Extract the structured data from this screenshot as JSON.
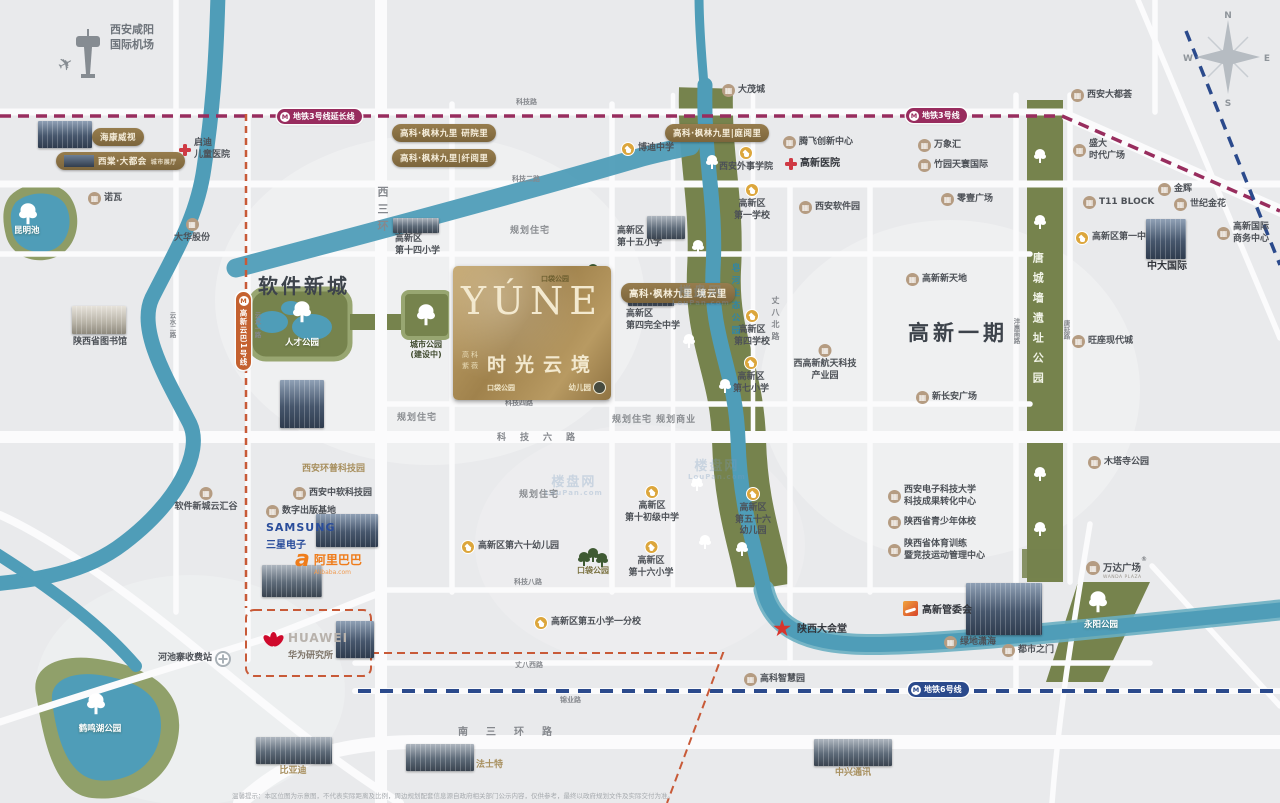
{
  "project": {
    "name_en": "YÚNE",
    "name_cn": "时光云境",
    "dev1": "高科",
    "dev2": "紫薇",
    "pocket_park": "口袋公园",
    "kindergarten": "幼儿园"
  },
  "airport": {
    "line1": "西安咸阳",
    "line2": "国际机场"
  },
  "compass": {
    "n": "N",
    "w": "W",
    "s": "S",
    "e": "E"
  },
  "metro": {
    "mark": "M",
    "line3_ext": "地铁3号线延长线",
    "line3": "地铁3号线",
    "line6": "地铁6号线",
    "cloud_rail": "高新云巴1号线"
  },
  "districts": [
    {
      "id": "software-new-town",
      "label": "软件新城"
    },
    {
      "id": "gaoxin-phase1",
      "label": "高新一期"
    }
  ],
  "badges": [
    {
      "id": "hikvision",
      "t": "海康威视",
      "x": 92,
      "y": 128
    },
    {
      "id": "xitang",
      "t": "西棠·大都会",
      "sub": "城市展厅",
      "x": 56,
      "y": 152,
      "pic": true
    },
    {
      "id": "fenglin-1",
      "t": "高科·枫林九里 研院里",
      "x": 392,
      "y": 124
    },
    {
      "id": "fenglin-2",
      "t": "高科·枫林九里|纤阅里",
      "x": 392,
      "y": 149
    },
    {
      "id": "fenglin-3",
      "t": "高科·枫林九里|庭阅里",
      "x": 665,
      "y": 124
    },
    {
      "id": "fenglin-4",
      "t": "高科·枫林九里 境云里",
      "x": 621,
      "y": 283,
      "fs": 9.5
    }
  ],
  "pois": [
    {
      "id": "damaocheng",
      "icon": "bldg",
      "label": "大茂城",
      "x": 722,
      "y": 84
    },
    {
      "id": "nuowa",
      "icon": "bldg",
      "label": "诺瓦",
      "x": 88,
      "y": 192
    },
    {
      "id": "dahua",
      "icon": "bldg",
      "label": "大华股份",
      "x": 192,
      "y": 218,
      "cls": "col"
    },
    {
      "id": "qidi-hospital",
      "icon": "cross",
      "label": "启迪\n儿童医院",
      "x": 178,
      "y": 138
    },
    {
      "id": "bodi-school",
      "icon": "school",
      "label": "博迪中学",
      "x": 621,
      "y": 142
    },
    {
      "id": "waishi-college",
      "icon": "school",
      "label": "西安外事学院",
      "x": 746,
      "y": 146,
      "cls": "col"
    },
    {
      "id": "tengfei",
      "icon": "bldg",
      "label": "腾飞创新中心",
      "x": 783,
      "y": 136
    },
    {
      "id": "gaoxin-hospital",
      "icon": "cross",
      "label": "高新医院",
      "x": 784,
      "y": 157,
      "cls": "dark"
    },
    {
      "id": "wanxianghui",
      "icon": "bldg",
      "label": "万象汇",
      "x": 918,
      "y": 139
    },
    {
      "id": "zhuyuan",
      "icon": "bldg",
      "label": "竹园天寰国际",
      "x": 918,
      "y": 159
    },
    {
      "id": "daduhui",
      "icon": "bldg",
      "label": "西安大都荟",
      "x": 1071,
      "y": 89
    },
    {
      "id": "shengda",
      "icon": "bldg",
      "label": "盛大\n时代广场",
      "x": 1073,
      "y": 139
    },
    {
      "id": "jinhui",
      "icon": "bldg",
      "label": "金辉",
      "x": 1158,
      "y": 183
    },
    {
      "id": "shiji-jinhua",
      "icon": "bldg",
      "label": "世纪金花",
      "x": 1174,
      "y": 198
    },
    {
      "id": "t11-block",
      "icon": "bldg",
      "label": "T11 BLOCK",
      "x": 1083,
      "y": 196
    },
    {
      "id": "gx-no1-middle",
      "icon": "school",
      "label": "高新区第一中学",
      "x": 1075,
      "y": 231
    },
    {
      "id": "zhongda-intl",
      "icon": "none",
      "label": "中大国际",
      "x": 1167,
      "y": 260,
      "cls": "col dark"
    },
    {
      "id": "gx-intl-biz",
      "icon": "bldg",
      "label": "高新国际\n商务中心",
      "x": 1217,
      "y": 222
    },
    {
      "id": "wangzuo",
      "icon": "bldg",
      "label": "旺座现代城",
      "x": 1072,
      "y": 335
    },
    {
      "id": "lingyi-plaza",
      "icon": "bldg",
      "label": "零壹广场",
      "x": 941,
      "y": 193
    },
    {
      "id": "xa-software-park",
      "icon": "bldg",
      "label": "西安软件园",
      "x": 799,
      "y": 201
    },
    {
      "id": "gx-xintiandi",
      "icon": "bldg",
      "label": "高新新天地",
      "x": 906,
      "y": 273
    },
    {
      "id": "hangtian-park",
      "icon": "bldg",
      "label": "西高新航天科技\n产业园",
      "x": 825,
      "y": 344,
      "cls": "col"
    },
    {
      "id": "xinchangan",
      "icon": "bldg",
      "label": "新长安广场",
      "x": 916,
      "y": 391
    },
    {
      "id": "gx-no1-school",
      "icon": "school",
      "label": "高新区\n第一学校",
      "x": 752,
      "y": 183,
      "cls": "col"
    },
    {
      "id": "gx-15-primary",
      "icon": "none",
      "label": "高新区\n第十五小学",
      "x": 617,
      "y": 226
    },
    {
      "id": "gx-14-primary",
      "icon": "none",
      "label": "高新区\n第十四小学",
      "x": 395,
      "y": 234
    },
    {
      "id": "gx-4-complete",
      "icon": "none",
      "label": "高新区\n第四完全中学",
      "x": 626,
      "y": 309
    },
    {
      "id": "gx-4-school",
      "icon": "school",
      "label": "高新区\n第四学校",
      "x": 752,
      "y": 309,
      "cls": "col"
    },
    {
      "id": "gx-7-primary",
      "icon": "school",
      "label": "高新区\n第七小学",
      "x": 751,
      "y": 356,
      "cls": "col"
    },
    {
      "id": "gx-10-junior",
      "icon": "school",
      "label": "高新区\n第十初级中学",
      "x": 652,
      "y": 485,
      "cls": "col"
    },
    {
      "id": "gx-16-primary",
      "icon": "school",
      "label": "高新区\n第十六小学",
      "x": 651,
      "y": 540,
      "cls": "col"
    },
    {
      "id": "gx-56-kinder",
      "icon": "school",
      "label": "高新区\n第五十六\n幼儿园",
      "x": 753,
      "y": 487,
      "cls": "col"
    },
    {
      "id": "gx-60-kinder",
      "icon": "school",
      "label": "高新区第六十幼儿园",
      "x": 461,
      "y": 540
    },
    {
      "id": "pocket-park-s",
      "icon": "none",
      "label": "口袋公园",
      "x": 593,
      "y": 566,
      "cls": "col parcel-dark"
    },
    {
      "id": "huanpu-park",
      "icon": "none",
      "label": "西安环普科技园",
      "x": 302,
      "y": 464,
      "cls": "gold"
    },
    {
      "id": "zhongruan-park",
      "icon": "bldg",
      "label": "西安中软科技园",
      "x": 293,
      "y": 487
    },
    {
      "id": "digital-publish",
      "icon": "bldg",
      "label": "数字出版基地",
      "x": 266,
      "y": 505
    },
    {
      "id": "yunhuigu",
      "icon": "bldg",
      "label": "软件新城云汇谷",
      "x": 206,
      "y": 487,
      "cls": "col"
    },
    {
      "id": "shaanxi-library",
      "icon": "none",
      "label": "陕西省图书馆",
      "x": 100,
      "y": 337,
      "cls": "col"
    },
    {
      "id": "xidian-center",
      "icon": "bldg",
      "label": "西安电子科技大学\n科技成果转化中心",
      "x": 888,
      "y": 485
    },
    {
      "id": "youth-sports",
      "icon": "bldg",
      "label": "陕西省青少年体校",
      "x": 888,
      "y": 516
    },
    {
      "id": "sports-training",
      "icon": "bldg",
      "label": "陕西省体育训练\n暨竞技运动管理中心",
      "x": 888,
      "y": 539
    },
    {
      "id": "muta-temple-park",
      "icon": "bldg",
      "label": "木塔寺公园",
      "x": 1088,
      "y": 456
    },
    {
      "id": "lvdi-xiaohai",
      "icon": "bldg",
      "label": "绿地潇海",
      "x": 944,
      "y": 636
    },
    {
      "id": "dushizhimen",
      "icon": "bldg",
      "label": "都市之门",
      "x": 1002,
      "y": 644
    },
    {
      "id": "shaanxi-hall",
      "icon": "star",
      "label": "陕西大会堂",
      "x": 770,
      "y": 617,
      "cls": "dark"
    },
    {
      "id": "gx-5-branch",
      "icon": "school",
      "label": "高新区第五小学一分校",
      "x": 534,
      "y": 616
    },
    {
      "id": "zhihuiyuan",
      "icon": "bldg",
      "label": "高科智慧园",
      "x": 744,
      "y": 673
    },
    {
      "id": "hechizhai-toll",
      "icon": "toll",
      "label": "河池寨收费站",
      "x": 158,
      "y": 651,
      "iconRight": true
    },
    {
      "id": "byd",
      "icon": "none",
      "label": "比亚迪",
      "x": 293,
      "y": 766,
      "cls": "col gold"
    },
    {
      "id": "fast-gear",
      "icon": "none",
      "label": "法士特",
      "x": 476,
      "y": 760,
      "cls": "gold"
    },
    {
      "id": "zte",
      "icon": "none",
      "label": "中兴通讯",
      "x": 853,
      "y": 768,
      "cls": "col gold"
    },
    {
      "id": "heminghu-park",
      "icon": "none",
      "label": "鹤鸣湖公园",
      "x": 100,
      "y": 724,
      "cls": "col white"
    },
    {
      "id": "kunmingchi",
      "icon": "none",
      "label": "昆明池",
      "x": 14,
      "y": 226,
      "cls": "white"
    },
    {
      "id": "rencai-park",
      "icon": "none",
      "label": "人才公园",
      "x": 302,
      "y": 338,
      "cls": "col white"
    },
    {
      "id": "city-park",
      "icon": "none",
      "label": "城市公园\n(建设中)",
      "x": 426,
      "y": 340,
      "cls": "col parkdark"
    },
    {
      "id": "yongyang-park",
      "icon": "none",
      "label": "永阳公园",
      "x": 1101,
      "y": 620,
      "cls": "col white"
    },
    {
      "id": "plan-res-1",
      "icon": "none",
      "label": "规划住宅",
      "x": 510,
      "y": 226,
      "cls": "plan"
    },
    {
      "id": "plan-res-2",
      "icon": "none",
      "label": "规划住宅",
      "x": 397,
      "y": 413,
      "cls": "plan"
    },
    {
      "id": "plan-res-3",
      "icon": "none",
      "label": "规划住宅",
      "x": 519,
      "y": 490,
      "cls": "plan"
    },
    {
      "id": "plan-res-biz",
      "icon": "none",
      "label": "规划住宅  规划商业",
      "x": 612,
      "y": 415,
      "cls": "plan"
    },
    {
      "id": "zaohe-eco-park",
      "icon": "none",
      "label": "皂河生态公园",
      "x": 729,
      "y": 263,
      "cls": "river"
    },
    {
      "id": "tangcheng-wall-park",
      "icon": "none",
      "label": "唐城墙遗址公园",
      "x": 1030,
      "y": 252,
      "cls": "strip"
    }
  ],
  "road_labels": [
    {
      "id": "keji-rd",
      "t": "科技路",
      "x": 516,
      "y": 97,
      "s": 7
    },
    {
      "id": "keji-2-rd",
      "t": "科技二路",
      "x": 512,
      "y": 174,
      "s": 7
    },
    {
      "id": "keji-4-rd",
      "t": "科技四路",
      "x": 505,
      "y": 398,
      "s": 7
    },
    {
      "id": "keji-6-rd",
      "t": "科技六路",
      "x": 497,
      "y": 430,
      "s": 9,
      "ls": 14
    },
    {
      "id": "keji-8-rd",
      "t": "科技八路",
      "x": 514,
      "y": 577,
      "s": 7
    },
    {
      "id": "zhangba-w-rd",
      "t": "丈八西路",
      "x": 515,
      "y": 660,
      "s": 7
    },
    {
      "id": "jinye-rd",
      "t": "锦业路",
      "x": 560,
      "y": 695,
      "s": 7
    },
    {
      "id": "south-3rd-ring",
      "t": "南三环路",
      "x": 458,
      "y": 723,
      "s": 10,
      "ls": 18
    },
    {
      "id": "west-3rd-ring",
      "t": "西三环",
      "x": 374,
      "y": 186,
      "s": 11,
      "ls": 6,
      "v": true
    },
    {
      "id": "zhangba-n-rd",
      "t": "丈八北路",
      "x": 770,
      "y": 296,
      "s": 8,
      "ls": 4,
      "v": true
    },
    {
      "id": "fenghui-s-rd",
      "t": "沣惠南路",
      "x": 1011,
      "y": 318,
      "s": 6.5,
      "v": true
    },
    {
      "id": "tangyan-rd",
      "t": "唐延路",
      "x": 1061,
      "y": 320,
      "s": 6.5,
      "v": true
    },
    {
      "id": "yunshui-1-rd",
      "t": "云水一路",
      "x": 252,
      "y": 312,
      "s": 6.5,
      "v": true
    },
    {
      "id": "yunshui-2-rd",
      "t": "云水二路",
      "x": 167,
      "y": 312,
      "s": 6.5,
      "v": true
    }
  ],
  "trees": [
    {
      "x": 1034,
      "y": 146
    },
    {
      "x": 1034,
      "y": 212
    },
    {
      "x": 1034,
      "y": 464
    },
    {
      "x": 1034,
      "y": 519
    },
    {
      "x": 706,
      "y": 152
    },
    {
      "x": 692,
      "y": 237
    },
    {
      "x": 683,
      "y": 331
    },
    {
      "x": 719,
      "y": 376
    },
    {
      "x": 691,
      "y": 474
    },
    {
      "x": 699,
      "y": 532
    },
    {
      "x": 736,
      "y": 539
    },
    {
      "x": 296,
      "y": 302,
      "big": true
    },
    {
      "x": 420,
      "y": 305,
      "big": true
    },
    {
      "x": 22,
      "y": 204,
      "big": true
    },
    {
      "x": 90,
      "y": 694,
      "big": true
    },
    {
      "x": 1092,
      "y": 592,
      "big": true
    },
    {
      "x": 578,
      "y": 265,
      "d": true,
      "n": 3
    },
    {
      "x": 456,
      "y": 378,
      "d": true,
      "n": 3
    },
    {
      "x": 578,
      "y": 549,
      "d": true,
      "n": 3
    }
  ],
  "pics": [
    {
      "id": "hikvision-pic",
      "x": 38,
      "y": 121,
      "w": 54,
      "h": 27
    },
    {
      "id": "library-pic",
      "x": 72,
      "y": 306,
      "w": 54,
      "h": 28,
      "v": "light"
    },
    {
      "id": "school14-pic",
      "x": 393,
      "y": 218,
      "w": 46,
      "h": 15,
      "v": "steel"
    },
    {
      "id": "school15-pic",
      "x": 647,
      "y": 216,
      "w": 38,
      "h": 23,
      "v": "steel"
    },
    {
      "id": "school4-pic",
      "x": 628,
      "y": 288,
      "w": 46,
      "h": 18,
      "v": "steel"
    },
    {
      "id": "zhongda-pic",
      "x": 1146,
      "y": 219,
      "w": 40,
      "h": 40
    },
    {
      "id": "towers-pic",
      "x": 280,
      "y": 380,
      "w": 44,
      "h": 48
    },
    {
      "id": "samsung-pic",
      "x": 316,
      "y": 514,
      "w": 62,
      "h": 33
    },
    {
      "id": "alibaba-pic",
      "x": 262,
      "y": 565,
      "w": 60,
      "h": 32,
      "v": "steel"
    },
    {
      "id": "huawei-pic",
      "x": 336,
      "y": 621,
      "w": 38,
      "h": 37
    },
    {
      "id": "gwh-pic",
      "x": 966,
      "y": 583,
      "w": 76,
      "h": 52
    },
    {
      "id": "byd-pic",
      "x": 256,
      "y": 737,
      "w": 76,
      "h": 27,
      "v": "steel"
    },
    {
      "id": "fast-pic",
      "x": 406,
      "y": 744,
      "w": 68,
      "h": 27,
      "v": "steel"
    },
    {
      "id": "zte-pic",
      "x": 814,
      "y": 739,
      "w": 78,
      "h": 27,
      "v": "steel"
    }
  ],
  "brands": {
    "samsung": {
      "en": "SAMSUNG",
      "cn": "三星电子"
    },
    "alibaba": {
      "logo": "a",
      "cn": "阿里巴巴",
      "en": "Alibaba.com"
    },
    "huawei": {
      "en": "HUAWEI",
      "cn": "华为研究所"
    },
    "wanda": {
      "cn": "万达广场",
      "reg": "®",
      "en": "WANDA PLAZA"
    },
    "gwh": {
      "cn": "高新管委会"
    }
  },
  "watermark": {
    "t": "楼盘网",
    "s": "LouPan.com",
    "pos": [
      [
        672,
        286
      ],
      [
        545,
        476
      ],
      [
        688,
        460
      ]
    ]
  },
  "disclaimer": "温馨提示：本区位图为示意图，不代表实际距离及比例，周边规划配套信息源自政府相关部门公示内容，仅供参考，最终以政府规划文件及实际交付为准。"
}
